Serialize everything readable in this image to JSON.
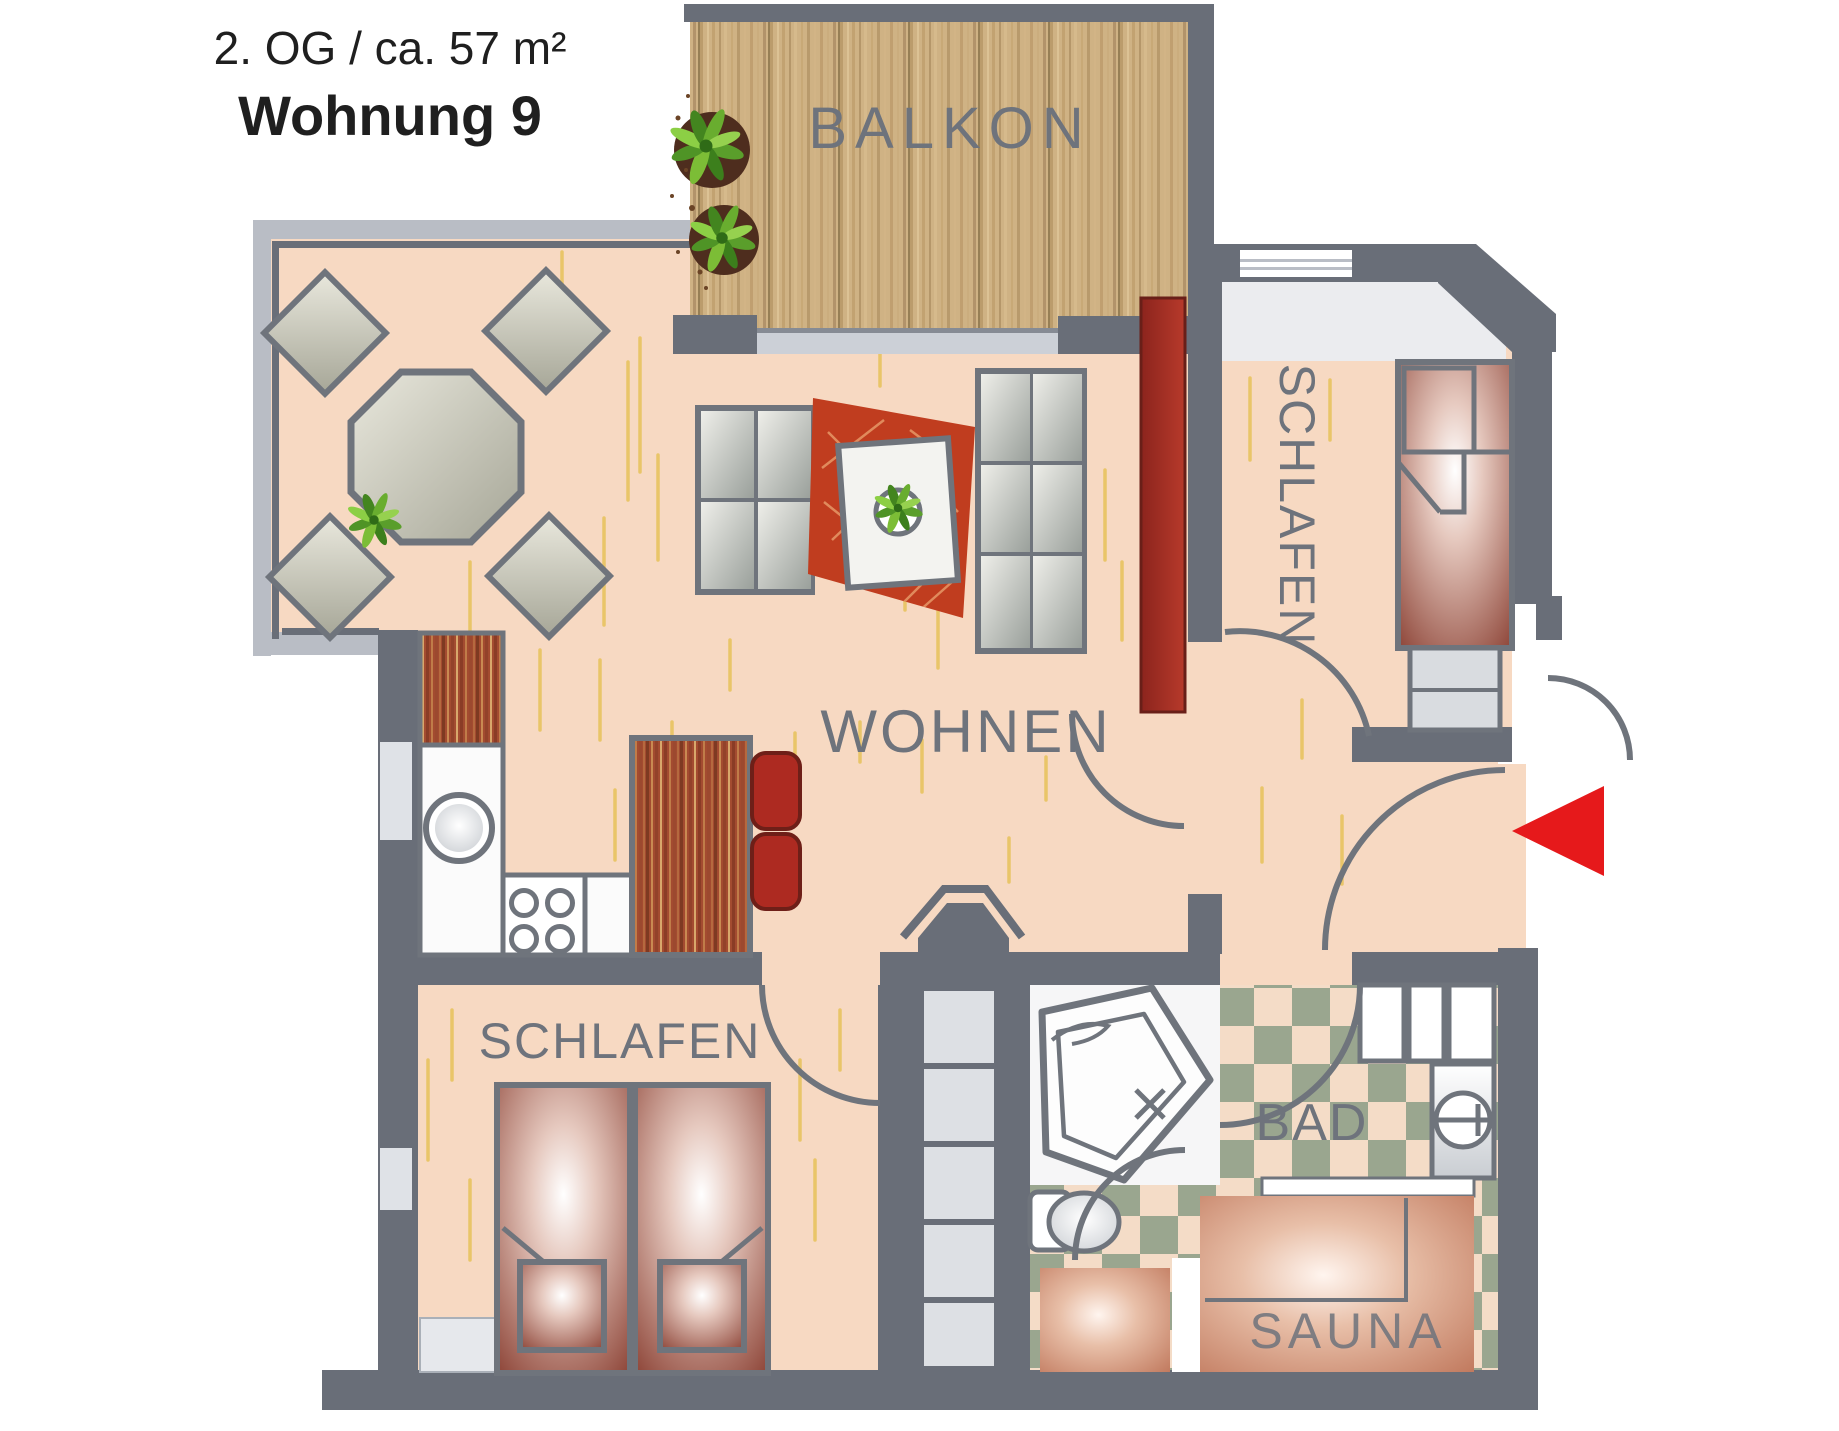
{
  "title": {
    "line1": "2. OG / ca. 57 m²",
    "line2": "Wohnung 9"
  },
  "rooms": {
    "balcony": "BALKON",
    "living": "WOHNEN",
    "bedroom_top": "SCHLAFEN",
    "bedroom_bottom": "SCHLAFEN",
    "bathroom": "BAD",
    "sauna": "SAUNA"
  },
  "colors": {
    "wall_dark": "#696e78",
    "wall_light": "#b9bdc5",
    "floor_peach": "#f7d9c2",
    "floor_stroke_yellow": "#e9c569",
    "balcony_wood": "#cfb284",
    "red_wood": "#a34b30",
    "rug_red": "#c03d1f",
    "accent_red": "#ad2a21",
    "sideboard_red": "#9c2b22",
    "bed_maroon": "#8c4336",
    "sauna_tone": "#bb6f53",
    "tile_green": "#9aa68f",
    "tile_peach": "#f4dcc7",
    "furniture_gray": "#9ea49f",
    "label_gray": "#6e737c",
    "arrow_red": "#e6191b",
    "title_black": "#1f1f1f"
  },
  "icons": {
    "entrance_arrow": "left-pointing red triangle marking the apartment entrance",
    "plant": "potted green plant seen from above",
    "sink": "round kitchen sink",
    "stove": "four-burner cooktop",
    "bathtub": "corner bathtub",
    "toilet": "toilet seen from above",
    "washbasin": "washbasin with faucet cross"
  }
}
